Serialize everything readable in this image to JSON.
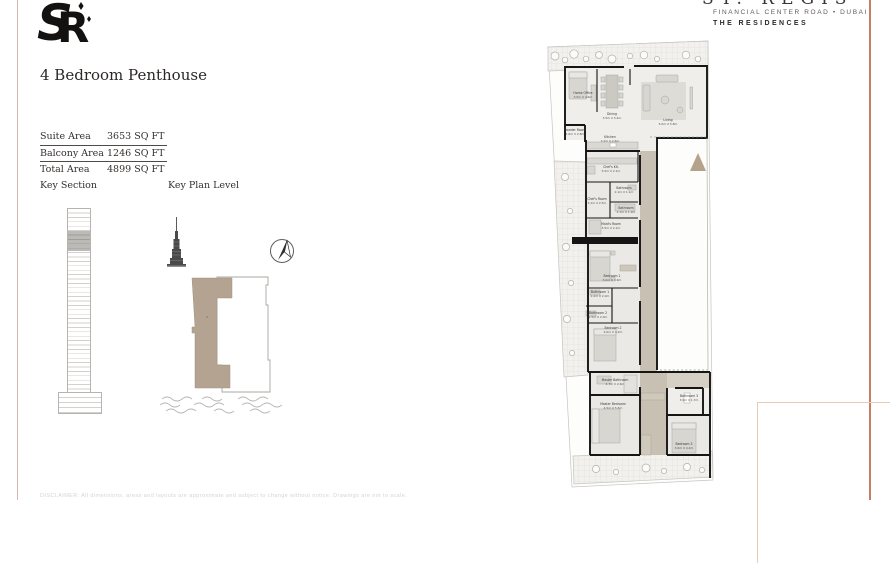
{
  "brand": {
    "monogram": {
      "s": "S",
      "r": "R"
    },
    "wordmark": "ST. REGIS",
    "address": "FINANCIAL CENTER ROAD • DUBAI",
    "residences": "THE RESIDENCES"
  },
  "page": {
    "title": "4 Bedroom Penthouse",
    "disclaimer": "DISCLAIMER: All dimensions, areas and layouts are approximate and subject to change without notice. Drawings are not to scale."
  },
  "areas": {
    "rows": [
      {
        "label": "Suite Area",
        "value": "3653 SQ FT"
      },
      {
        "label": "Balcony Area",
        "value": "1246 SQ FT"
      },
      {
        "label": "Total Area",
        "value": "4899 SQ FT"
      }
    ]
  },
  "keys": {
    "section_label": "Key Section",
    "plan_label": "Key Plan Level"
  },
  "floorplan": {
    "rooms": [
      {
        "name": "Home Office",
        "dims": "3.5m X 4.6m"
      },
      {
        "name": "Dining",
        "dims": "3.5m X 5.4m"
      },
      {
        "name": "Living",
        "dims": "5.0m X 5.8m"
      },
      {
        "name": "Powder Room",
        "dims": "1.6m X 2.8m"
      },
      {
        "name": "Kitchen",
        "dims": "3.2m X 2.6m"
      },
      {
        "name": "Chef's Kit.",
        "dims": "5.5m X 2.1m"
      },
      {
        "name": "Bathroom",
        "dims": "2.1m X 1.1m"
      },
      {
        "name": "Chef's Room",
        "dims": "3.1m X 2.5m"
      },
      {
        "name": "Bathroom",
        "dims": "2.1m X 1.9m"
      },
      {
        "name": "Maid's Room",
        "dims": "5.5m X 2.1m"
      },
      {
        "name": "Bedroom 1",
        "dims": "5.0m X 3.9m"
      },
      {
        "name": "Bathroom 1",
        "dims": "2.2m X 2.0m"
      },
      {
        "name": "Bathroom 2",
        "dims": "2.5m X 2.0m"
      },
      {
        "name": "Bedroom 2",
        "dims": "4.0m X 4.2m"
      },
      {
        "name": "Master Bathroom",
        "dims": "4.7m X 2.6m"
      },
      {
        "name": "Master Bedroom",
        "dims": "4.5m X 5.5m"
      },
      {
        "name": "Bathroom 3",
        "dims": "3.9m X 1.7m"
      },
      {
        "name": "Bedroom 3",
        "dims": "3.6m X 4.2m"
      }
    ]
  },
  "colors": {
    "accent_tan": "#b4a28a",
    "corridor_tan": "#c8c0b3",
    "border_red": "#c67e62",
    "border_pink": "#d9b6ab",
    "wall_black": "#151515"
  }
}
